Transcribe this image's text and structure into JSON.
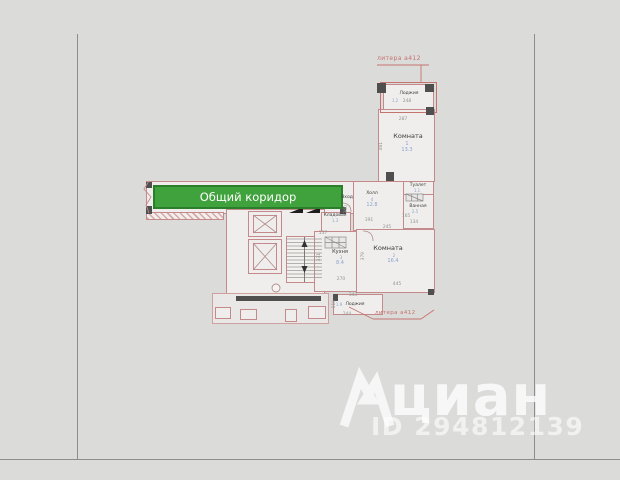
{
  "corridor": {
    "label": "Общий коридор",
    "fill_color": "#3fa23c",
    "border_color": "#2c7f2a"
  },
  "labels": {
    "entrance": "Вход"
  },
  "annotations": {
    "liter_top": "литера а412",
    "liter_bottom": "литера а412",
    "color": "#c4736e"
  },
  "rooms": {
    "room1": {
      "name": "Комната",
      "num": "1",
      "area": "13.3"
    },
    "hall": {
      "name": "Холл",
      "num": "4",
      "area": "12.8"
    },
    "toilet": {
      "name": "Туалет",
      "area": "1.1"
    },
    "bath": {
      "name": "Ванная",
      "area": "2.5"
    },
    "storage": {
      "name": "Кладовая",
      "area": "1.3"
    },
    "kitchen": {
      "name": "Кухня",
      "num": "3",
      "area": "8.4"
    },
    "room2": {
      "name": "Комната",
      "num": "2",
      "area": "16.4"
    },
    "loggia_top": {
      "name": "Лоджия",
      "area": "1.2"
    },
    "loggia_bottom": {
      "name": "Лоджия",
      "area": "1.9"
    }
  },
  "dimensions": {
    "d248": "248",
    "d287": "287",
    "d481": "481",
    "d391": "391",
    "d245": "245",
    "d360": "360",
    "d165": "165",
    "d134": "134",
    "d137": "137",
    "d270": "270",
    "d445": "445",
    "d379": "379",
    "d331": "331",
    "d343": "343",
    "d244": "244",
    "d110": "110"
  },
  "watermark": {
    "brand": "циан",
    "listing_id": "ID 294812139"
  },
  "colors": {
    "background": "#dbdbda",
    "wall": "#c4898b",
    "area_text": "#8ba3cc",
    "dim_text": "#96948e"
  }
}
